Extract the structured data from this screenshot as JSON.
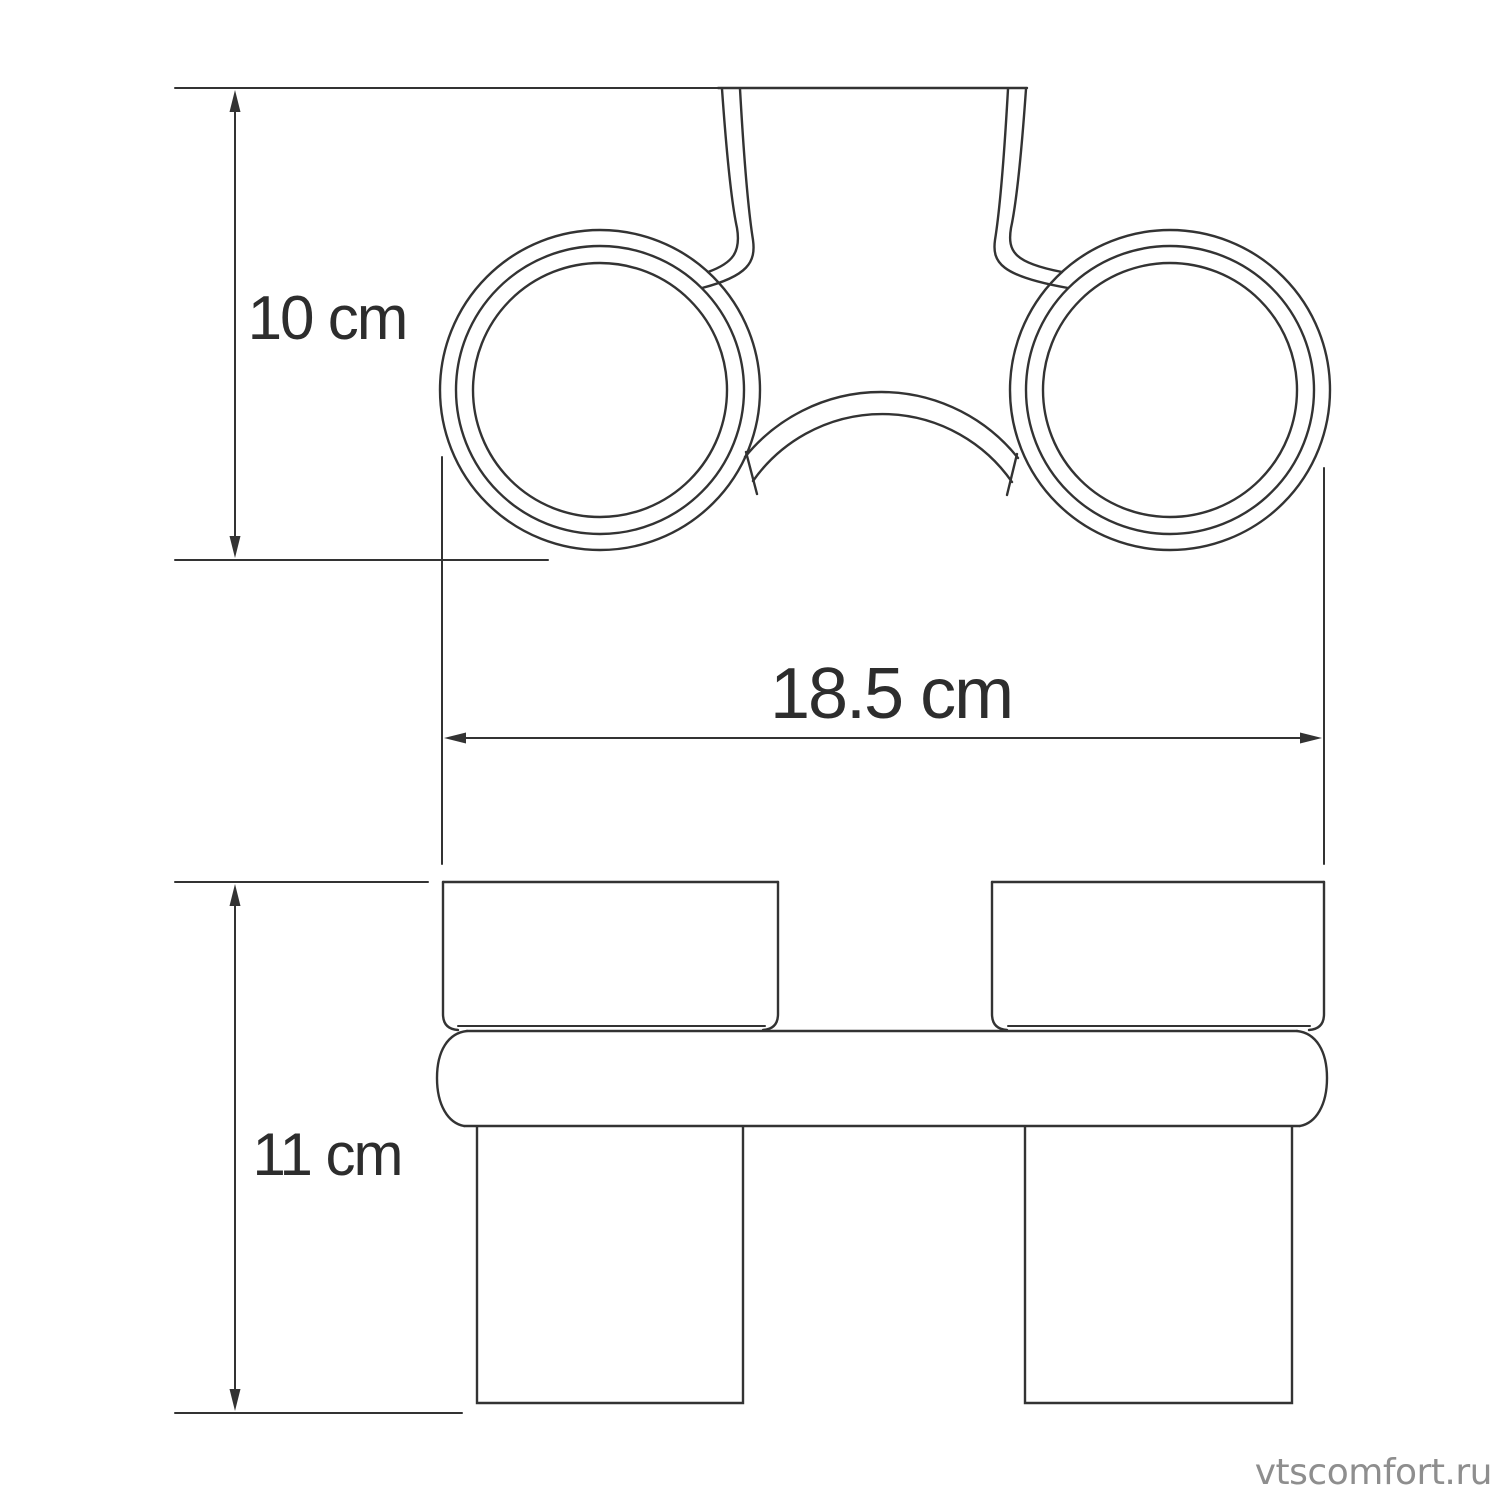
{
  "document": {
    "type": "product-dimension-drawing",
    "views": {
      "top_view": "wall bracket with two round tumbler holder rings",
      "front_view": "two glass tumblers seated in a double holder rail"
    }
  },
  "dimensions": {
    "top_view_height": {
      "label": "10 cm",
      "value": 10,
      "unit": "cm"
    },
    "overall_width": {
      "label": "18.5 cm",
      "value": 18.5,
      "unit": "cm"
    },
    "front_view_height": {
      "label": "11 cm",
      "value": 11,
      "unit": "cm"
    }
  },
  "watermark": {
    "text": "vtscomfort.ru",
    "color": "#8e8e8e"
  },
  "colors": {
    "background": "#ffffff",
    "line": "#333333",
    "dimension_text": "#2d2d2d"
  }
}
